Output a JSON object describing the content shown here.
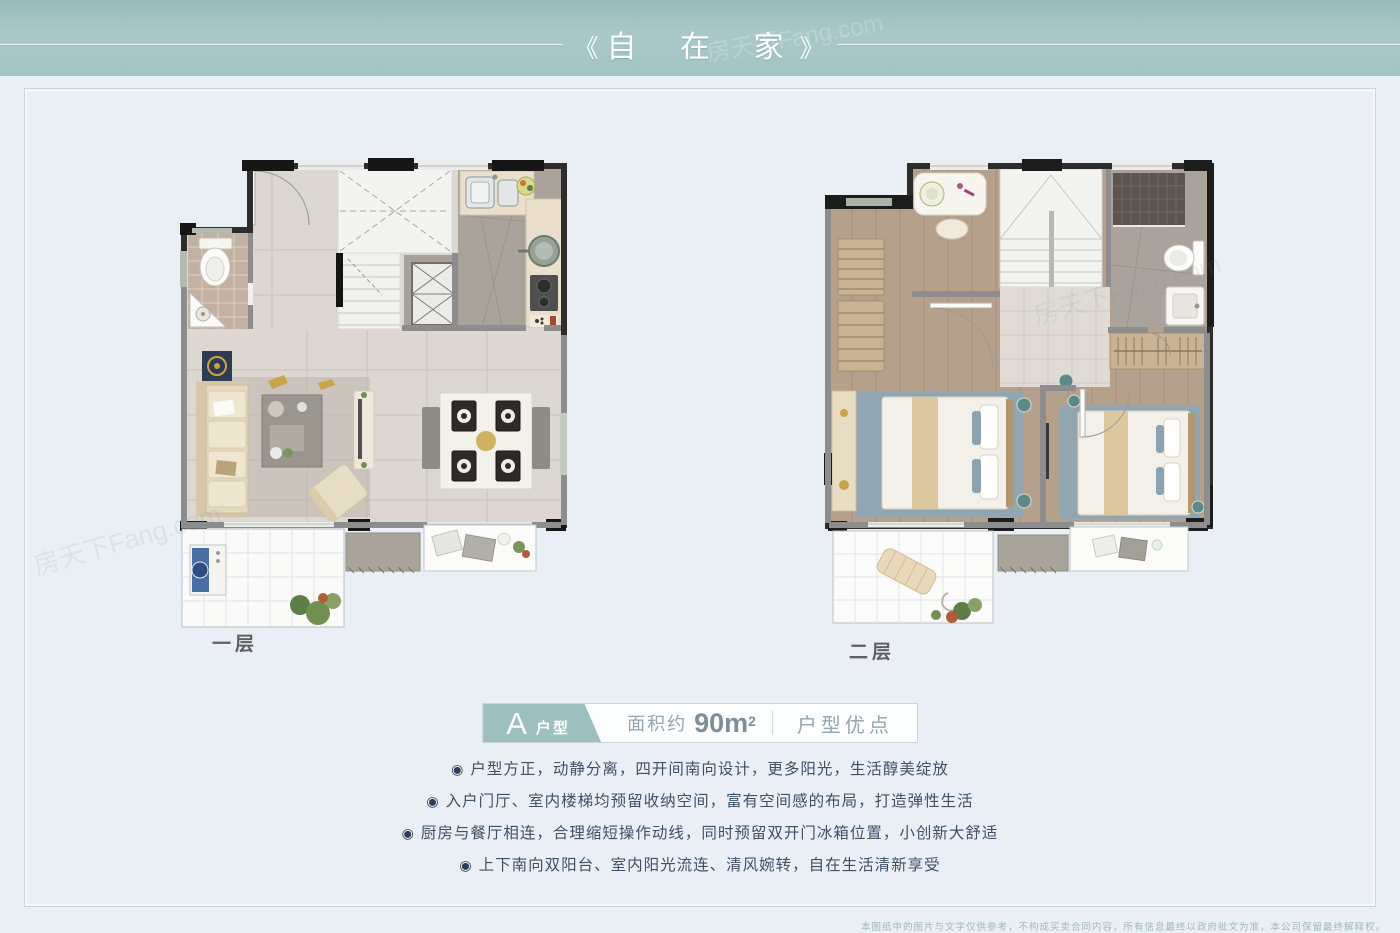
{
  "banner": {
    "left_bracket": "《",
    "title": "自 在 家",
    "right_bracket": "》",
    "bg_color": "#a6c5c6",
    "text_color": "#ffffff"
  },
  "watermark": "房天下Fang.com",
  "plans": [
    {
      "label": "一层"
    },
    {
      "label": "二层"
    }
  ],
  "unit_info": {
    "unit_letter": "A",
    "unit_label": "户型",
    "area_prefix": "面积约",
    "area_value": "90m",
    "area_sup": "2",
    "advantages_label": "户型优点",
    "badge_color": "#9dbfc0"
  },
  "bullet_glyph": "◉",
  "features": [
    "户型方正，动静分离，四开间南向设计，更多阳光，生活醇美绽放",
    "入户门厅、室内楼梯均预留收纳空间，富有空间感的布局，打造弹性生活",
    "厨房与餐厅相连，合理缩短操作动线，同时预留双开门冰箱位置，小创新大舒适",
    "上下南向双阳台、室内阳光流连、清风婉转，自在生活清新享受"
  ],
  "disclaimer": "本图纸中的图片与文字仅供参考，不构成买卖合同内容，所有信息最终以政府批文为准，本公司保留最终解释权。",
  "colors": {
    "page_bg": "#e9eff5",
    "frame_border": "#c9d5dd",
    "feature_text": "#3f5166",
    "muted_text": "#95a6ad",
    "wall_dark": "#2b2b2b",
    "wood_floor": "#b5a08c",
    "marble_floor": "#dcd7d0",
    "rug_blue": "#91a6b0"
  }
}
